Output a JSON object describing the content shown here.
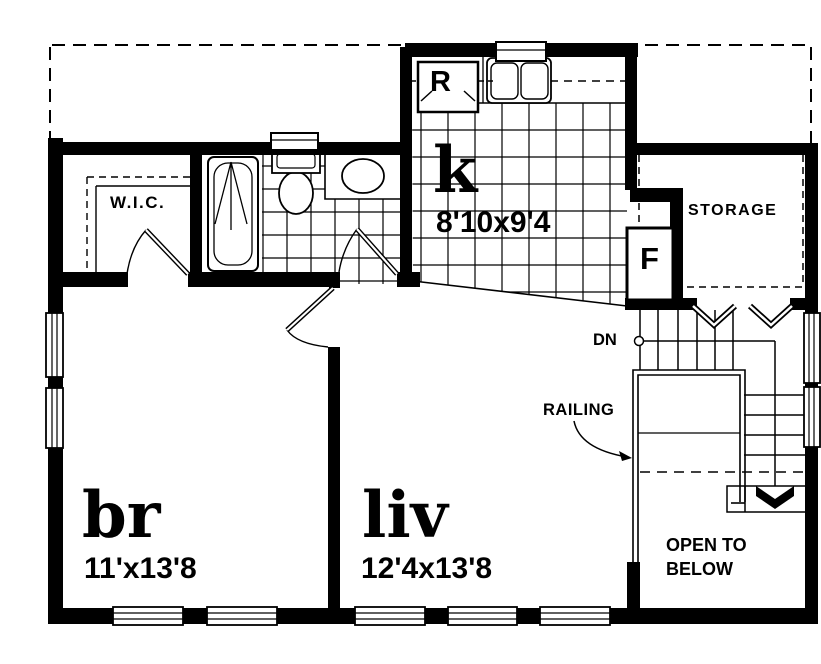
{
  "plan": {
    "ink": "#000000",
    "paper": "#ffffff",
    "labels": {
      "wic": "W.I.C.",
      "kitchen": "k",
      "kitchen_dims": "8'10x9'4",
      "storage": "STORAGE",
      "furnace": "F",
      "refrigerator": "R",
      "down": "DN",
      "railing": "RAILING",
      "bedroom": "br",
      "bedroom_dims": "11'x13'8",
      "living": "liv",
      "living_dims": "12'4x13'8",
      "open_below_1": "OPEN TO",
      "open_below_2": "BELOW"
    }
  }
}
